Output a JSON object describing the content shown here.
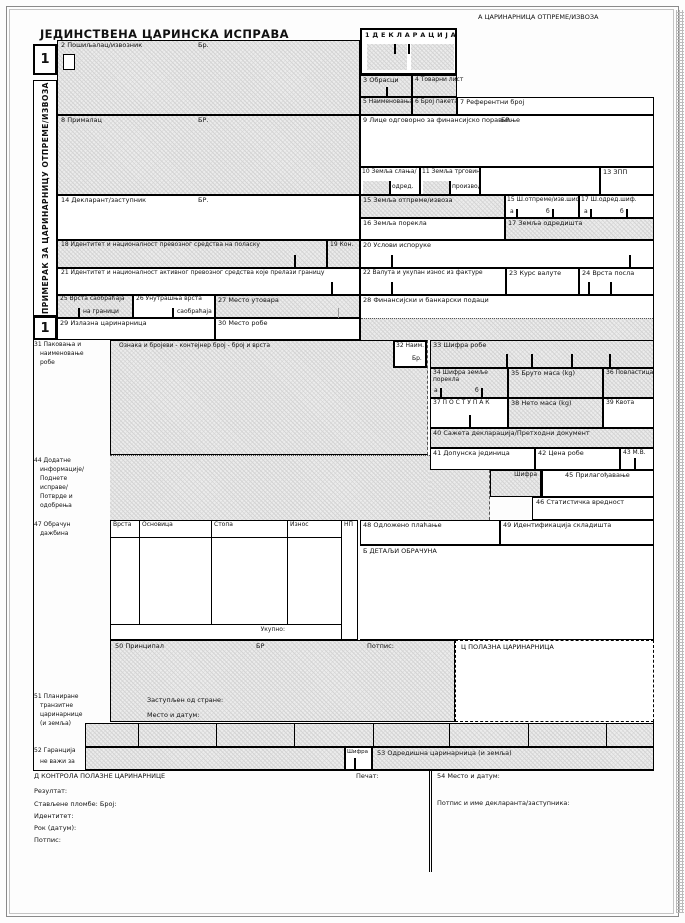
{
  "title": "ЈЕДИНСТВЕНА ЦАРИНСКА ИСПРАВА",
  "section_a": "А  ЦАРИНАРНИЦА ОТПРЕМЕ/ИЗВОЗА",
  "copy": {
    "number": "1",
    "label": "ПРИМЕРАК ЗА ЦАРИНАРНИЦУ ОТПРЕМЕ/ИЗВОЗА"
  },
  "colors": {
    "ink": "#000000",
    "shade": "#ececec"
  },
  "boxes": {
    "b1": "1 Д Е К Л А Р А Ц И Ј А",
    "b2": "2 Пошиљалац/извозник",
    "b2_no": "Бр.",
    "b3": "3 Обрасци",
    "b4": "4 Товарни лист",
    "b5": "5 Наименовања",
    "b6": "6 Број пакета",
    "b7": "7 Референтни број",
    "b8": "8 Прималац",
    "b8_no": "БР.",
    "b9": "9 Лице одговорно за финансијско поравнање",
    "b9_no": "БР.",
    "b10": "10 Земља слања/",
    "b10b": "одред.",
    "b11": "11 Земља трговине/",
    "b11b": "производ.",
    "b13": "13 ЗПП",
    "b14": "14 Декларант/заступник",
    "b14_no": "БР.",
    "b15": "15 Земља отпреме/извоза",
    "b15a": "15 Ш.отпреме/изв.шиф.",
    "b15a_a": "а",
    "b15a_b": "б",
    "b17a": "17 Ш.одред.шиф.",
    "b17a_a": "а",
    "b17a_b": "б",
    "b16": "16 Земља порекла",
    "b17": "17 Земља одредишта",
    "b18": "18 Идентитет и националност превозног средства на поласку",
    "b19": "19 Кон.",
    "b20": "20 Услови испоруке",
    "b21": "21 Идентитет и националност активног превозног средства које прелази границу",
    "b22": "22 Валута и укупан износ из фактуре",
    "b23": "23 Курс валуте",
    "b24": "24 Врста посла",
    "b25": "25 Врста саобраћаја",
    "b25b": "на граници",
    "b26": "26 Унутрашња врста",
    "b26b": "саобраћаја",
    "b27": "27 Место утовара",
    "b28": "28 Финансијски и банкарски подаци",
    "b29": "29 Излазна царинарница",
    "b30": "30 Место робе",
    "b31_lines": [
      "31 Паковања и",
      "наименовање",
      "робе"
    ],
    "b31_head": "Ознака и бројеви - контејнер број - број и врста",
    "b32": "32 Наим.",
    "b32b": "Бр.",
    "b33": "33 Шифра робе",
    "b34": "34 Шифра земље порекла",
    "b34_a": "а",
    "b34_b": "б",
    "b35": "35 Бруто маса (kg)",
    "b36": "36 Повластица",
    "b37": "37 П О С Т У П А К",
    "b38": "38 Нето маса (kg)",
    "b39": "39 Квота",
    "b40": "40 Сажета декларација/Претходни документ",
    "b41": "41 Допунска јединица",
    "b42": "42 Цена робе",
    "b43": "43 М.В.",
    "b44_lines": [
      "44 Додатне",
      "информације/",
      "Поднете",
      "исправе/",
      "Потврде и",
      "одобрења"
    ],
    "b44_code": "Шифра",
    "b45": "45 Прилагођавање",
    "b46": "46 Статистичка вредност",
    "b47_lines": [
      "47 Обрачун",
      "дажбина"
    ],
    "b47_cols": [
      "Врста",
      "Основица",
      "Стопа",
      "Износ",
      "НП"
    ],
    "b47_total": "Укупно:",
    "b48": "48 Одложено плаћање",
    "b49": "49 Идентификација складишта",
    "bB": "Б  ДЕТАЉИ ОБРАЧУНА",
    "b50": "50 Принципал",
    "b50_no": "БР",
    "b50_sign": "Потпис:",
    "b50_rep": "Заступљен од стране:",
    "b50_place": "Место и датум:",
    "bC": "Ц  ПОЛАЗНА ЦАРИНАРНИЦА",
    "b51_lines": [
      "51 Планиране",
      "транзитне",
      "царинарнице",
      "(и земља)"
    ],
    "b52": "52 Гаранција",
    "b52b": "не важи за",
    "b52_code": "Шифра",
    "b53": "53 Одредишна царинарница (и земља)",
    "bD": "Д   КОНТРОЛА ПОЛАЗНЕ ЦАРИНАРНИЦЕ",
    "bD_seal": "Печат:",
    "b54": "54 Место и датум:",
    "bD_result": "Резултат:",
    "bD_seals": "Стављене пломбе:  Број:",
    "bD_identity": "Идентитет:",
    "bD_deadline": "Рок (датум):",
    "bD_sign": "Потпис:",
    "b54_sign": "Потпис и име декларанта/заступника:"
  }
}
